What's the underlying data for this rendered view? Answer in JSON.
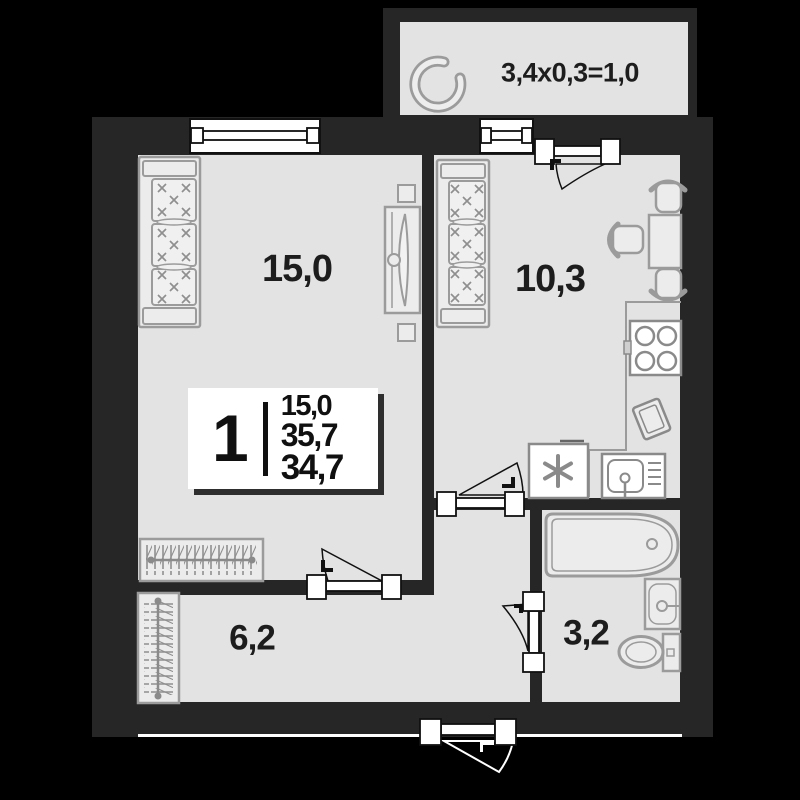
{
  "balcony": {
    "dimension_label": "3,4x0,3=1,0"
  },
  "rooms": {
    "living_room": {
      "area": "15,0"
    },
    "kitchen": {
      "area": "10,3"
    },
    "hallway": {
      "area": "6,2"
    },
    "bathroom": {
      "area": "3,2"
    }
  },
  "info_box": {
    "room_count": "1",
    "values": [
      "15,0",
      "35,7",
      "34,7"
    ]
  },
  "colors": {
    "background": "#000000",
    "wall": "#262626",
    "floor": "#e3e3e3",
    "furniture_outline": "#9b9b9b",
    "fixture_white": "#ffffff",
    "text": "#1d1d1d"
  }
}
